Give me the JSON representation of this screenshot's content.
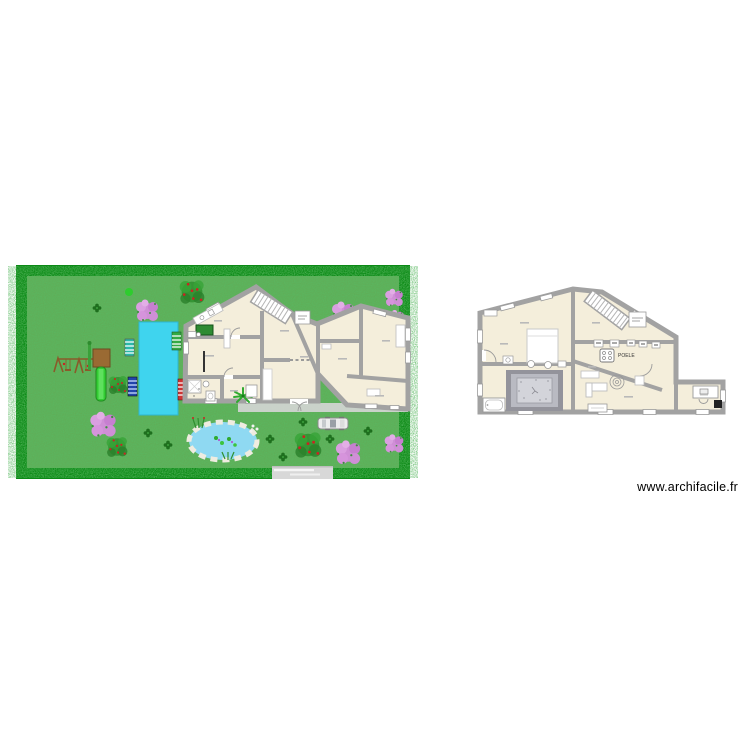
{
  "page": {
    "watermark": "www.archifacile.fr",
    "background": "#ffffff"
  },
  "garden": {
    "border_color": "#0c8a16",
    "grass_base": "#5fae58",
    "items": [
      {
        "name": "swimming-pool",
        "color": "#3fd4ee"
      },
      {
        "name": "pond",
        "color": "#8fd9f2"
      },
      {
        "name": "swing-set",
        "color": "#8a5a2a"
      },
      {
        "name": "slide",
        "color": "#33cc33"
      },
      {
        "name": "sun-lounger-teal",
        "color": "#2ab8a8"
      },
      {
        "name": "sun-lounger-navy",
        "color": "#2244aa"
      },
      {
        "name": "sun-lounger-green",
        "color": "#33aa44"
      },
      {
        "name": "sun-lounger-red",
        "color": "#cc3333"
      },
      {
        "name": "car",
        "color": "#ededed"
      },
      {
        "name": "driveway",
        "color": "#d8d8d8"
      },
      {
        "name": "pink-tree",
        "count": 7
      },
      {
        "name": "red-berry-bush",
        "count": 4
      },
      {
        "name": "small-bush",
        "count": 11
      }
    ]
  },
  "ground_floor": {
    "wall_color": "#a2a2a2",
    "floor_color": "#f4eedb"
  },
  "upper_floor": {
    "wall_color": "#a2a2a2",
    "floor_color": "#f4eedb",
    "stove_label": "POELE"
  }
}
